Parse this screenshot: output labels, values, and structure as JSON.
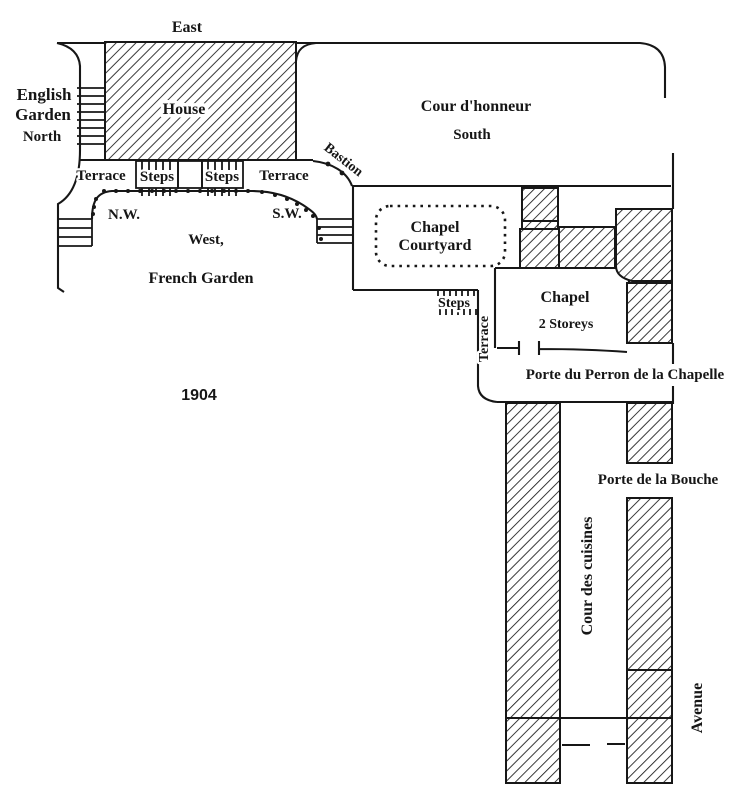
{
  "figure": {
    "year": "1904",
    "colors": {
      "ink": "#171717",
      "paper": "#ffffff"
    },
    "labels": {
      "east": "East",
      "english_garden_line1": "English",
      "english_garden_line2": "Garden",
      "north": "North",
      "house": "House",
      "cour_honneur": "Cour d'honneur",
      "south": "South",
      "bastion": "Bastion",
      "terrace_left": "Terrace",
      "steps_left": "Steps",
      "steps_right": "Steps",
      "terrace_right": "Terrace",
      "nw": "N.W.",
      "sw": "S.W.",
      "west": "West,",
      "french_garden": "French Garden",
      "chapel_courtyard_line1": "Chapel",
      "chapel_courtyard_line2": "Courtyard",
      "steps_chapel": "Steps",
      "chapel": "Chapel",
      "chapel_storeys": "2 Storeys",
      "terrace_chapel": "Terrace",
      "porte_perron": "Porte du Perron de la Chapelle",
      "porte_bouche": "Porte de la Bouche",
      "cour_cuisines": "Cour des cuisines",
      "avenue": "Avenue"
    }
  }
}
